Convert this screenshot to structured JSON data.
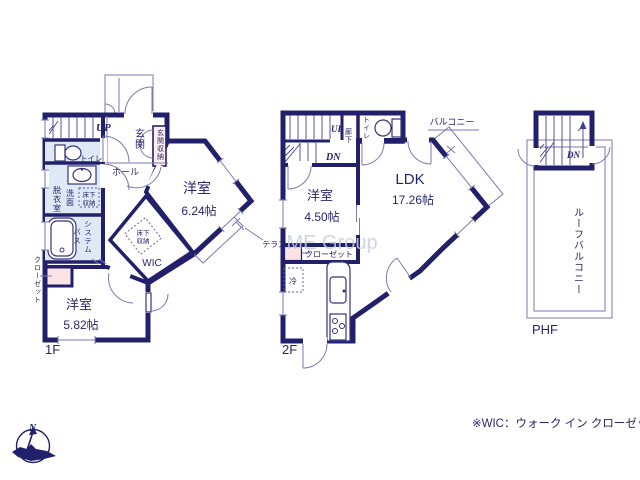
{
  "colors": {
    "wall_navy": "#23206b",
    "room_cream": "#f8e8c3",
    "wet_blue": "#dfe9f6",
    "storage_pink": "#fbe2e3",
    "storage_pink_light": "#fdf0ef",
    "watermark_gray": "#c9cde0"
  },
  "floor1": {
    "label": "1F",
    "up": "UP",
    "entrance": "玄関",
    "entrance_storage": "玄関収納",
    "hall": "ホール",
    "toilet": "トイレ",
    "dressing": "脱衣室",
    "wash": "洗面",
    "underfloor": {
      "line1": "床下",
      "line2": "収納"
    },
    "bath": {
      "col1": "システム",
      "col2": "バス"
    },
    "closet": "クローゼット",
    "room_a": {
      "name": "洋室",
      "size": "6.24帖"
    },
    "wic_underfloor": {
      "line1": "床下",
      "line2": "収納"
    },
    "wic": "WIC",
    "terrace": "テラス",
    "room_b": {
      "name": "洋室",
      "size": "5.82帖"
    }
  },
  "floor2": {
    "label": "2F",
    "up": "UP",
    "down": "DN",
    "corridor": "廊下",
    "toilet": "トイレ",
    "balcony": "バルコニー",
    "room": {
      "name": "洋室",
      "size": "4.50帖"
    },
    "ldk": {
      "name": "LDK",
      "size": "17.26帖"
    },
    "closet": "クローゼット",
    "fridge": "冷"
  },
  "phf": {
    "label": "PHF",
    "down": "DN",
    "roof_balcony": "ルーフバルコニー"
  },
  "compass": {
    "north": "N"
  },
  "watermark": "ME Group",
  "footnote": "※WIC：ウォーク イン クローゼット"
}
